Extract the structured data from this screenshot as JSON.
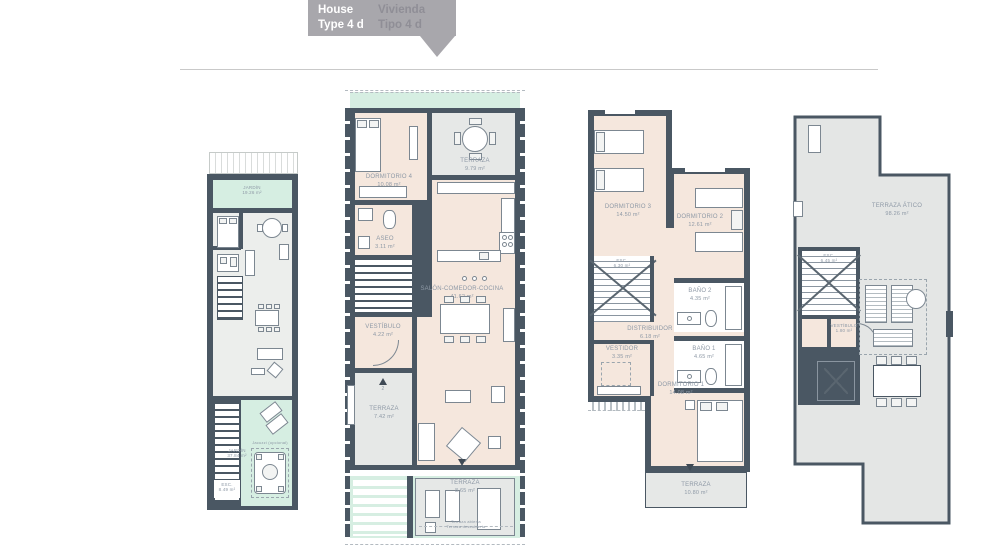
{
  "header": {
    "en_line1": "House",
    "en_line2": "Type 4 d",
    "es_line1": "Vivienda",
    "es_line2": "Tipo 4 d"
  },
  "colors": {
    "wall": "#4a5763",
    "floor_beige": "#f5e7dd",
    "floor_gray": "#e6e8e7",
    "garden_green": "#d6eee2",
    "banner_gray": "#a8a7ac",
    "label_text": "#8e99a6"
  },
  "plans": {
    "ground_small": {
      "jardin_top": {
        "label": "JARDÍN",
        "area": "19.26 m²"
      },
      "jardin_bottom": {
        "label": "JARDÍN",
        "area": "37.84 m²"
      },
      "esc": {
        "label": "ESC.",
        "area": "8.49 m²"
      },
      "jacuzzi_note": "Jacuzzi (opcional)"
    },
    "ground_main": {
      "terraza_top": {
        "label": "TERRAZA",
        "area": "9.79 m²"
      },
      "dormitorio4": {
        "label": "DORMITORIO 4",
        "area": "10.08 m²"
      },
      "aseo": {
        "label": "ASEO",
        "area": "3.11 m²"
      },
      "salon": {
        "label": "SALÓN-COMEDOR-COCINA",
        "area": "41.62 m²"
      },
      "vestibulo": {
        "label": "VESTÍBULO",
        "area": "4.22 m²"
      },
      "terraza_left": {
        "label": "TERRAZA",
        "area": "7.42 m²"
      },
      "terraza_bottom": {
        "label": "TERRAZA",
        "area": "8.65 m²"
      },
      "open_note1": "Terraza abierta",
      "open_note2": "Terraza descubierta",
      "entry_number": "2"
    },
    "first_floor": {
      "dormitorio3": {
        "label": "DORMITORIO 3",
        "area": "14.50 m²"
      },
      "dormitorio2": {
        "label": "DORMITORIO 2",
        "area": "12.61 m²"
      },
      "esc": {
        "label": "ESC.",
        "area": "6.30 m²"
      },
      "bano2": {
        "label": "BAÑO 2",
        "area": "4.35 m²"
      },
      "distribuidor": {
        "label": "DISTRIBUIDOR",
        "area": "6.18 m²"
      },
      "vestidor": {
        "label": "VESTIDOR",
        "area": "3.35 m²"
      },
      "bano1": {
        "label": "BAÑO 1",
        "area": "4.65 m²"
      },
      "dormitorio1": {
        "label": "DORMITORIO 1",
        "area": "14.08 m²"
      },
      "terraza": {
        "label": "TERRAZA",
        "area": "10.80 m²"
      }
    },
    "atico": {
      "terraza_atico": {
        "label": "TERRAZA ÁTICO",
        "area": "98.26 m²"
      },
      "esc": {
        "label": "ESC.",
        "area": "6.45 m²"
      },
      "vestibulo": {
        "label": "VESTÍBULO",
        "area": "1.80 m²"
      }
    }
  }
}
